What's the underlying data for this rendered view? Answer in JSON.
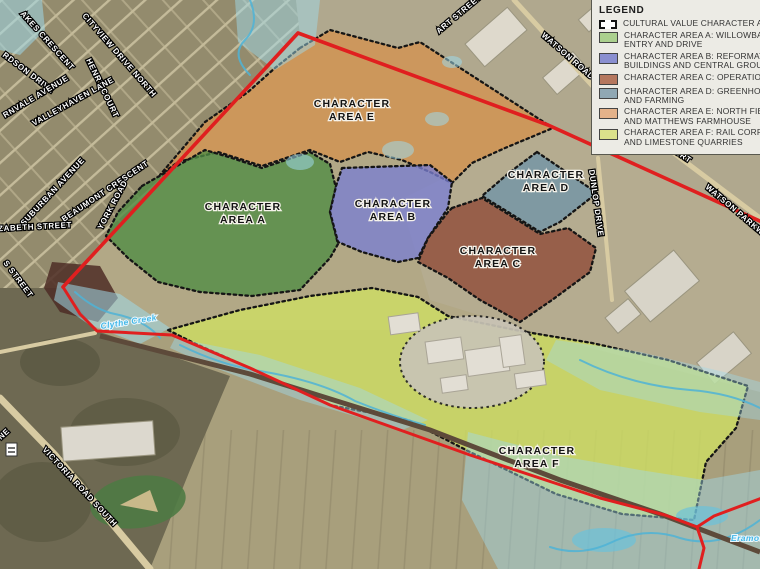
{
  "legend": {
    "title": "LEGEND",
    "items": [
      {
        "id": "cultural-value",
        "color": "#ffffff",
        "swatch": "dashed-outline",
        "lines": [
          "CULTURAL VALUE CHARACTER AREA"
        ]
      },
      {
        "id": "area-a",
        "color": "#abd08e",
        "lines": [
          "CHARACTER AREA A: WILLOWBANK",
          "ENTRY AND DRIVE"
        ]
      },
      {
        "id": "area-b",
        "color": "#8a8fd0",
        "lines": [
          "CHARACTER AREA B: REFORMATORY",
          "BUILDINGS AND CENTRAL GROUNDS"
        ]
      },
      {
        "id": "area-c",
        "color": "#b5775e",
        "lines": [
          "CHARACTER AREA C: OPERATIONS"
        ]
      },
      {
        "id": "area-d",
        "color": "#90a8b4",
        "lines": [
          "CHARACTER AREA D: GREENHOUSE",
          "AND FARMING"
        ]
      },
      {
        "id": "area-e",
        "color": "#e4b28a",
        "lines": [
          "CHARACTER AREA E: NORTH FIELDS",
          "AND MATTHEWS FARMHOUSE"
        ]
      },
      {
        "id": "area-f",
        "color": "#dbe18b",
        "lines": [
          "CHARACTER AREA F: RAIL CORRIDOR",
          "AND LIMESTONE QUARRIES"
        ]
      }
    ]
  },
  "areas": [
    {
      "id": "E",
      "line1": "CHARACTER",
      "line2": "AREA E",
      "map_fill": "#d4924f"
    },
    {
      "id": "A",
      "line1": "CHARACTER",
      "line2": "AREA A",
      "map_fill": "#4f8c44"
    },
    {
      "id": "B",
      "line1": "CHARACTER",
      "line2": "AREA B",
      "map_fill": "#7a7fd2"
    },
    {
      "id": "C",
      "line1": "CHARACTER",
      "line2": "AREA C",
      "map_fill": "#8e4936"
    },
    {
      "id": "D",
      "line1": "CHARACTER",
      "line2": "AREA D",
      "map_fill": "#6f94a6"
    },
    {
      "id": "F",
      "line1": "CHARACTER",
      "line2": "AREA F",
      "map_fill": "#cfe063"
    }
  ],
  "streets": [
    {
      "text": "AKES CRESCENT"
    },
    {
      "text": "RDSON DRIVE"
    },
    {
      "text": "CITYVIEW DRIVE NORTH"
    },
    {
      "text": "HENRY COURT"
    },
    {
      "text": "RNVALE AVENUE"
    },
    {
      "text": "VALLEYHAVEN LANE"
    },
    {
      "text": "SUBURBAN AVENUE"
    },
    {
      "text": "BEAUMONT CRESCENT"
    },
    {
      "text": "ELIZABETH STREET"
    },
    {
      "text": "S STREET"
    },
    {
      "text": "YORK ROAD"
    },
    {
      "text": "VICTORIA ROAD SOUTH"
    },
    {
      "text": "ART STREET"
    },
    {
      "text": "WATSON ROAD"
    },
    {
      "text": "WATSON PARKWAY"
    },
    {
      "text": "DUNLOP DRIVE"
    },
    {
      "text": "COURT"
    },
    {
      "text": "NE"
    }
  ],
  "water": {
    "labels": [
      {
        "text": "Clythe Creek"
      },
      {
        "text": "Eramosa"
      }
    ],
    "label_color": "#45b8e8",
    "overlay_color": "#9fd9ea",
    "stream_color": "#4fb3d6"
  },
  "boundary": {
    "site_color": "#e01f1f",
    "character_area_outline": "#151515"
  }
}
